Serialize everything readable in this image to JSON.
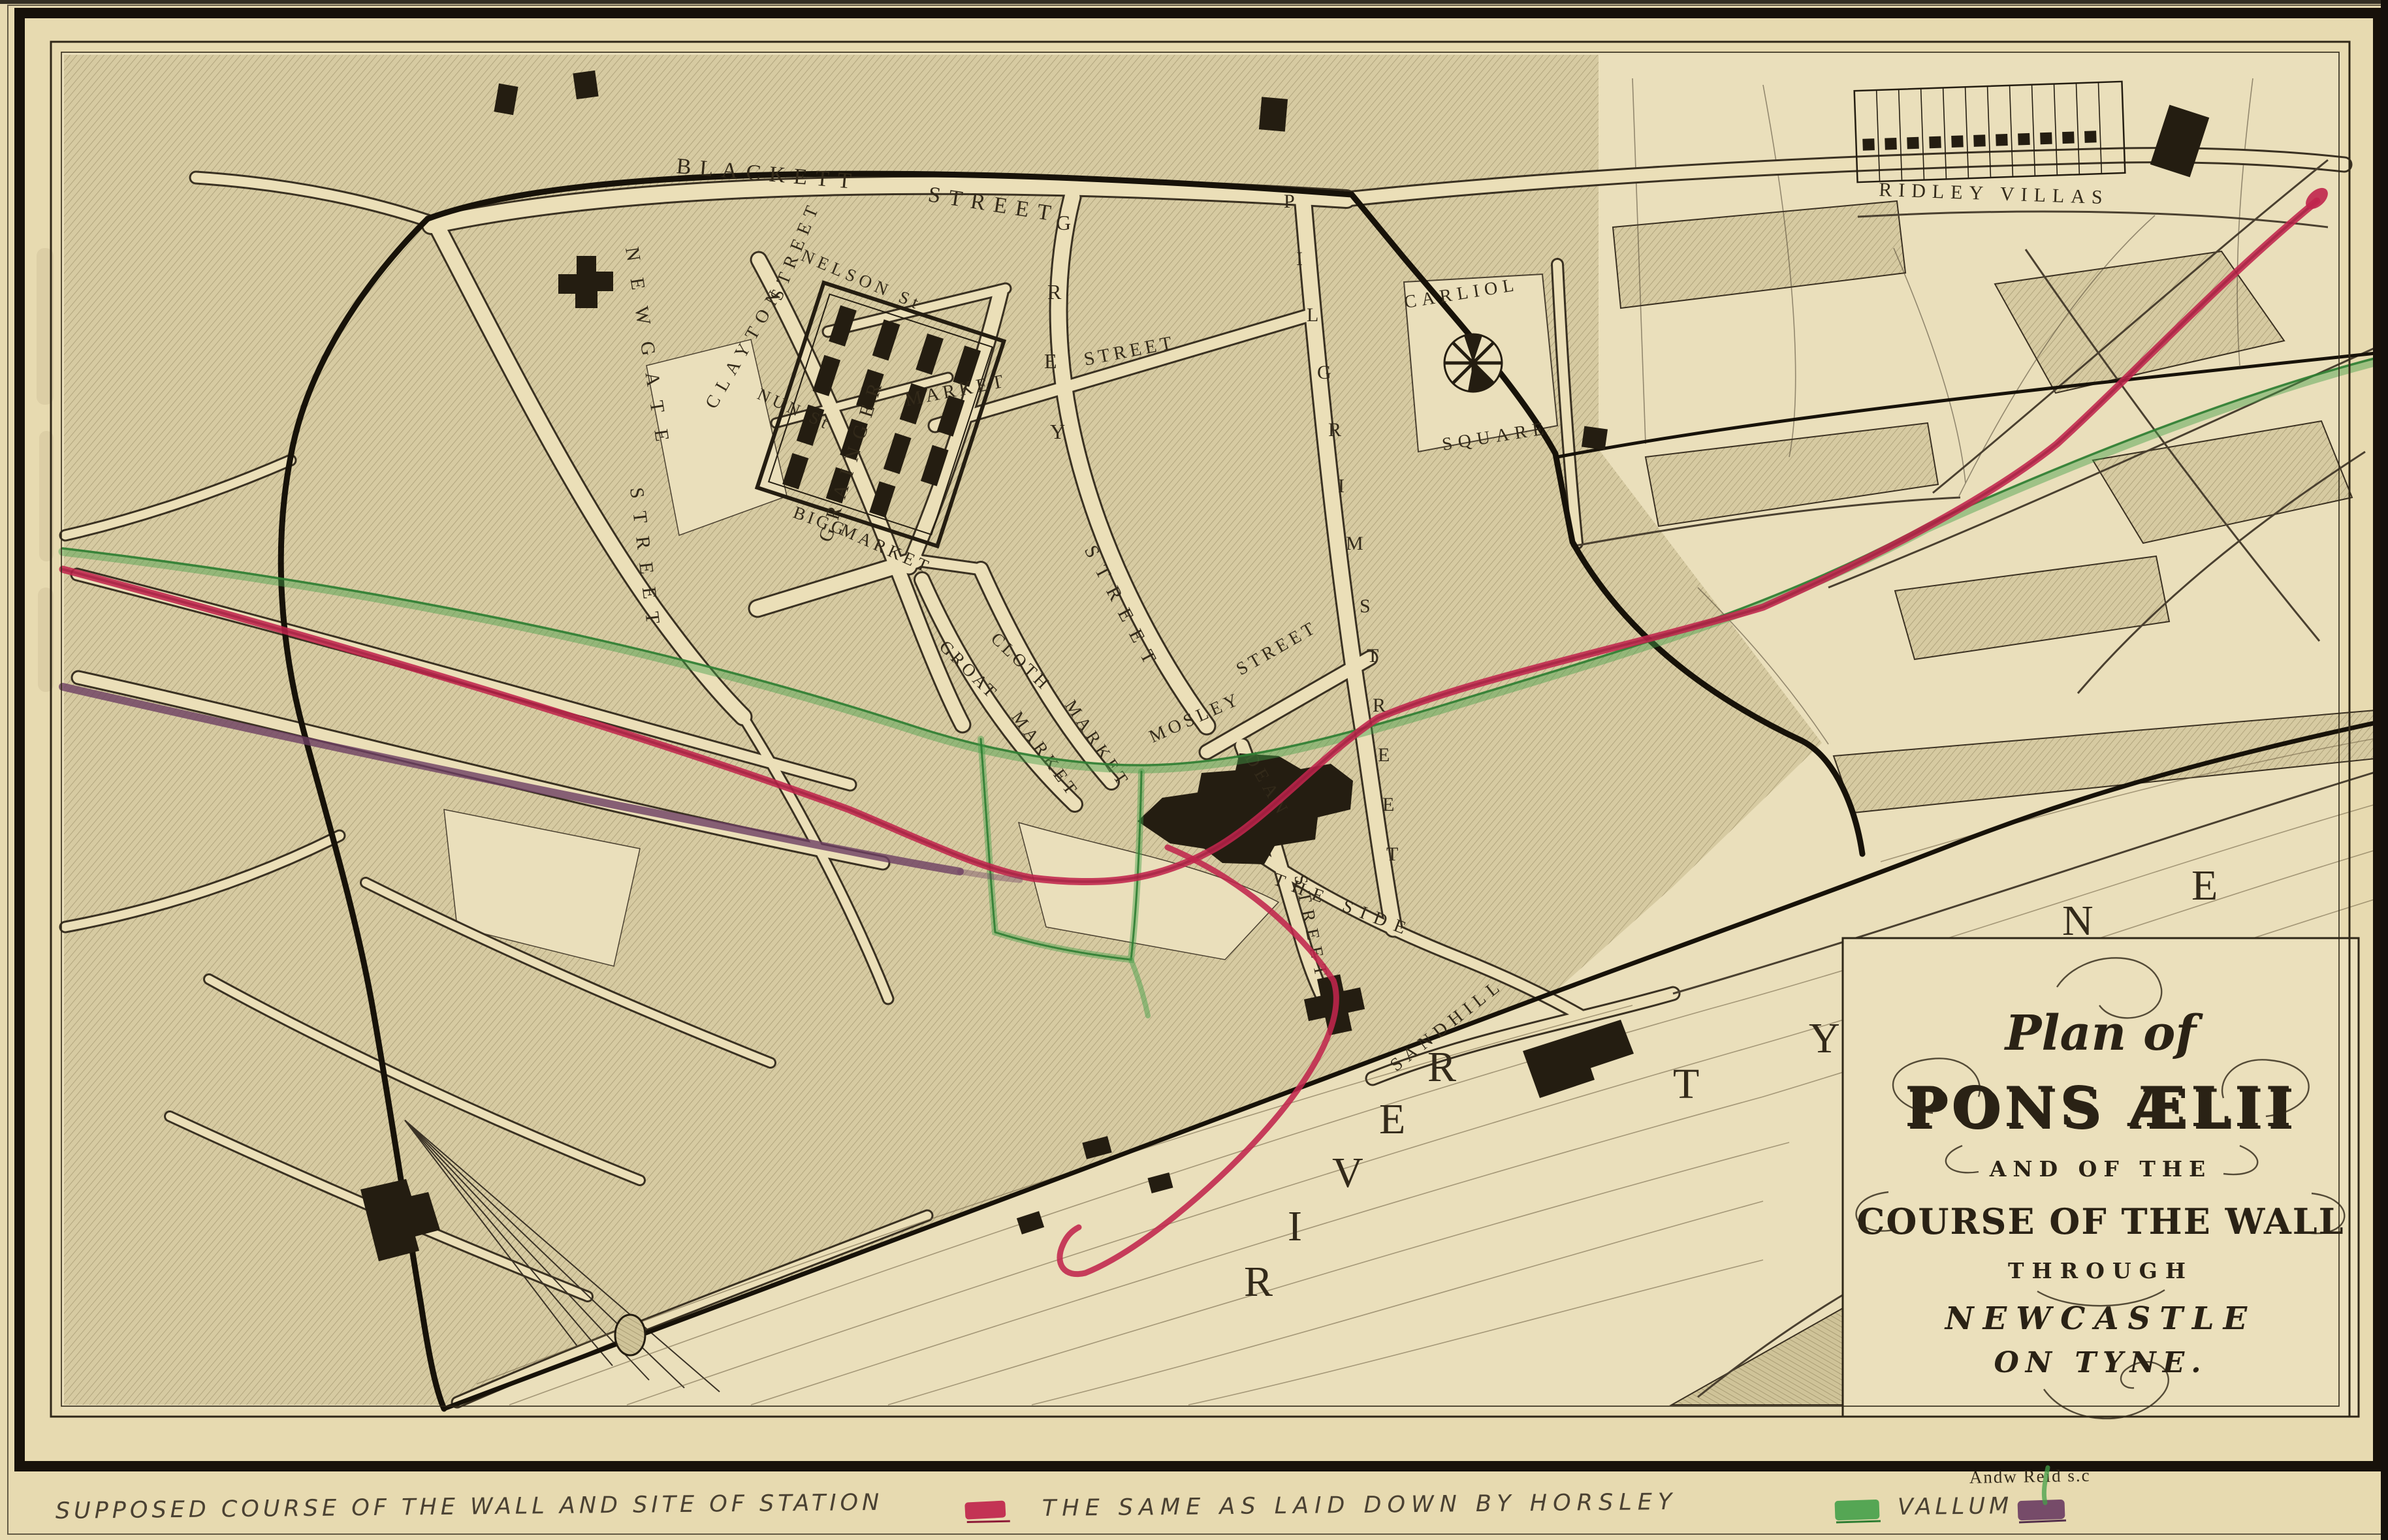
{
  "title_cartouche": {
    "line1": "Plan of",
    "line2": "PONS ÆLII",
    "line3": "AND OF THE",
    "line4": "COURSE OF THE WALL",
    "line5": "THROUGH",
    "line6": "NEWCASTLE",
    "line7": "ON TYNE."
  },
  "map_labels": {
    "blackett": "BLACKETT",
    "blackett_street": "STREET",
    "ridley_villas": "RIDLEY VILLAS",
    "newgate": "NEWGATE",
    "newgate_street": "STREET",
    "clayton": "CLAYTON",
    "clayton_street": "STREET",
    "nelson": "NELSON St",
    "nun": "NUN St",
    "grainger": "GRAINGER",
    "bigg": "BIGG",
    "bigg_market": "MARKET",
    "grey": "GREY",
    "grey_street": "STREET",
    "market": "MARKET",
    "market_street": "STREET",
    "pilgrim": "PILGRIM",
    "pilgrim_street": "STREET",
    "carliol": "CARLIOL",
    "carliol_square": "SQUARE",
    "cloth": "CLOTH",
    "cloth_market": "MARKET",
    "groat": "GROAT",
    "groat_market": "MARKET",
    "mosley": "MOSLEY",
    "mosley_street": "STREET",
    "dean": "DEAN",
    "dean_street": "STREET",
    "the_side": "THE SIDE",
    "sandhill": "SANDHILL",
    "river": "RIVER",
    "tyne": "TYNE"
  },
  "legend": {
    "wall_label": "SUPPOSED COURSE OF THE WALL AND SITE OF STATION",
    "horsley_label": "THE SAME AS LAID DOWN BY HORSLEY",
    "vallum_label": "VALLUM",
    "wall_color": "#c0254c",
    "horsley_color": "#45a04a",
    "vallum_color": "#6d3f63"
  },
  "credit": "Andw Reid s.c",
  "colors": {
    "paper": "#e7dab0",
    "map_paper": "#eadfbb",
    "block_hatch": "#d6caa1",
    "ink": "#2b2318",
    "wall_red": "#c0254c",
    "horsley_green": "#45a04a",
    "vallum_purple": "#6d3f63"
  }
}
